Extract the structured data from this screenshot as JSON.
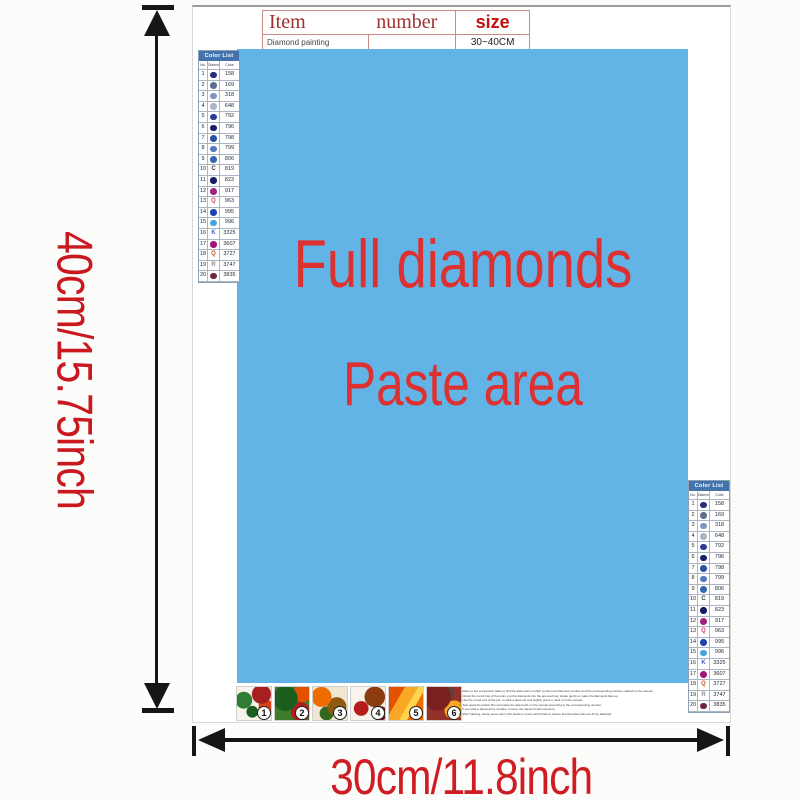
{
  "dimensions": {
    "height_label": "40cm/15.75inch",
    "width_label": "30cm/11.8inch"
  },
  "spec_table": {
    "header_item": "Item",
    "header_number": "number",
    "header_size": "size",
    "row_name": "Diamond painting",
    "row_number": "",
    "row_size": "30~40CM"
  },
  "paste_area": {
    "line1": "Full diamonds",
    "line2": "Paste area",
    "bg_color": "#62b4e6",
    "text_color": "#dd3131"
  },
  "color_list": {
    "title": "Color List",
    "columns": [
      "No.",
      "Diamond",
      "Color"
    ],
    "rows": [
      {
        "no": "1",
        "symbol": "",
        "symbol_type": "circle",
        "symbol_color": "#232d78",
        "code": "158"
      },
      {
        "no": "2",
        "symbol": "",
        "symbol_type": "circle",
        "symbol_color": "#5f6f8f",
        "code": "169"
      },
      {
        "no": "3",
        "symbol": "",
        "symbol_type": "circle",
        "symbol_color": "#7e96bd",
        "code": "318"
      },
      {
        "no": "4",
        "symbol": "",
        "symbol_type": "circle",
        "symbol_color": "#a9b6c4",
        "code": "648"
      },
      {
        "no": "5",
        "symbol": "",
        "symbol_type": "circle",
        "symbol_color": "#2a3c96",
        "code": "792"
      },
      {
        "no": "6",
        "symbol": "",
        "symbol_type": "circle",
        "symbol_color": "#151f6a",
        "code": "796"
      },
      {
        "no": "7",
        "symbol": "",
        "symbol_type": "circle",
        "symbol_color": "#2c4ea6",
        "code": "798"
      },
      {
        "no": "8",
        "symbol": "",
        "symbol_type": "circle",
        "symbol_color": "#5577c2",
        "code": "799"
      },
      {
        "no": "9",
        "symbol": "",
        "symbol_type": "circle",
        "symbol_color": "#3468ad",
        "code": "806"
      },
      {
        "no": "10",
        "symbol": "C",
        "symbol_type": "letter",
        "symbol_color": "#3a3a3a",
        "code": "819"
      },
      {
        "no": "11",
        "symbol": "",
        "symbol_type": "circle",
        "symbol_color": "#131c64",
        "code": "823"
      },
      {
        "no": "12",
        "symbol": "",
        "symbol_type": "circle",
        "symbol_color": "#a02180",
        "code": "917"
      },
      {
        "no": "13",
        "symbol": "Q",
        "symbol_type": "letter",
        "symbol_color": "#d43a63",
        "code": "963"
      },
      {
        "no": "14",
        "symbol": "",
        "symbol_type": "circle",
        "symbol_color": "#1e43b0",
        "code": "995"
      },
      {
        "no": "15",
        "symbol": "",
        "symbol_type": "circle",
        "symbol_color": "#45a3dd",
        "code": "996"
      },
      {
        "no": "16",
        "symbol": "K",
        "symbol_type": "letter",
        "symbol_color": "#3c64c8",
        "code": "3325"
      },
      {
        "no": "17",
        "symbol": "",
        "symbol_type": "circle",
        "symbol_color": "#a01378",
        "code": "3607"
      },
      {
        "no": "18",
        "symbol": "Q",
        "symbol_type": "letter",
        "symbol_color": "#c8501e",
        "code": "3727"
      },
      {
        "no": "19",
        "symbol": "R",
        "symbol_type": "letter",
        "symbol_color": "#8b8b95",
        "code": "3747"
      },
      {
        "no": "20",
        "symbol": "",
        "symbol_type": "circle",
        "symbol_color": "#6b2840",
        "code": "3835"
      }
    ]
  },
  "steps": {
    "numbers": [
      "1",
      "2",
      "3",
      "4",
      "5",
      "6"
    ]
  },
  "instructions": {
    "lines": [
      "1. Refer to the comparison table to find the diamonds in which symbol and diamond number and the corresponding number marked on the canvas.",
      "2. Check the round tray of the tools, put the diamonds into the grooved tray, shake gently to make the diamonds face up.",
      "3. Use the round end of the pen to stick a diamond and slightly press it, stick it on the canvas.",
      "4. Tear apart the plastic film and paste the diamonds on the canvas according to the corresponding number.",
      "5. If you stick a diamond by mistake, remove the diamond with tweezers.",
      "6. After finishing, clamp press them with books or press with hands to ensure that the diamonds are firmly attached."
    ]
  },
  "colors": {
    "accent_red": "#cf1d24",
    "paste_blue": "#62b4e6",
    "list_header_blue": "#4273ad",
    "table_border": "#c98b85"
  }
}
